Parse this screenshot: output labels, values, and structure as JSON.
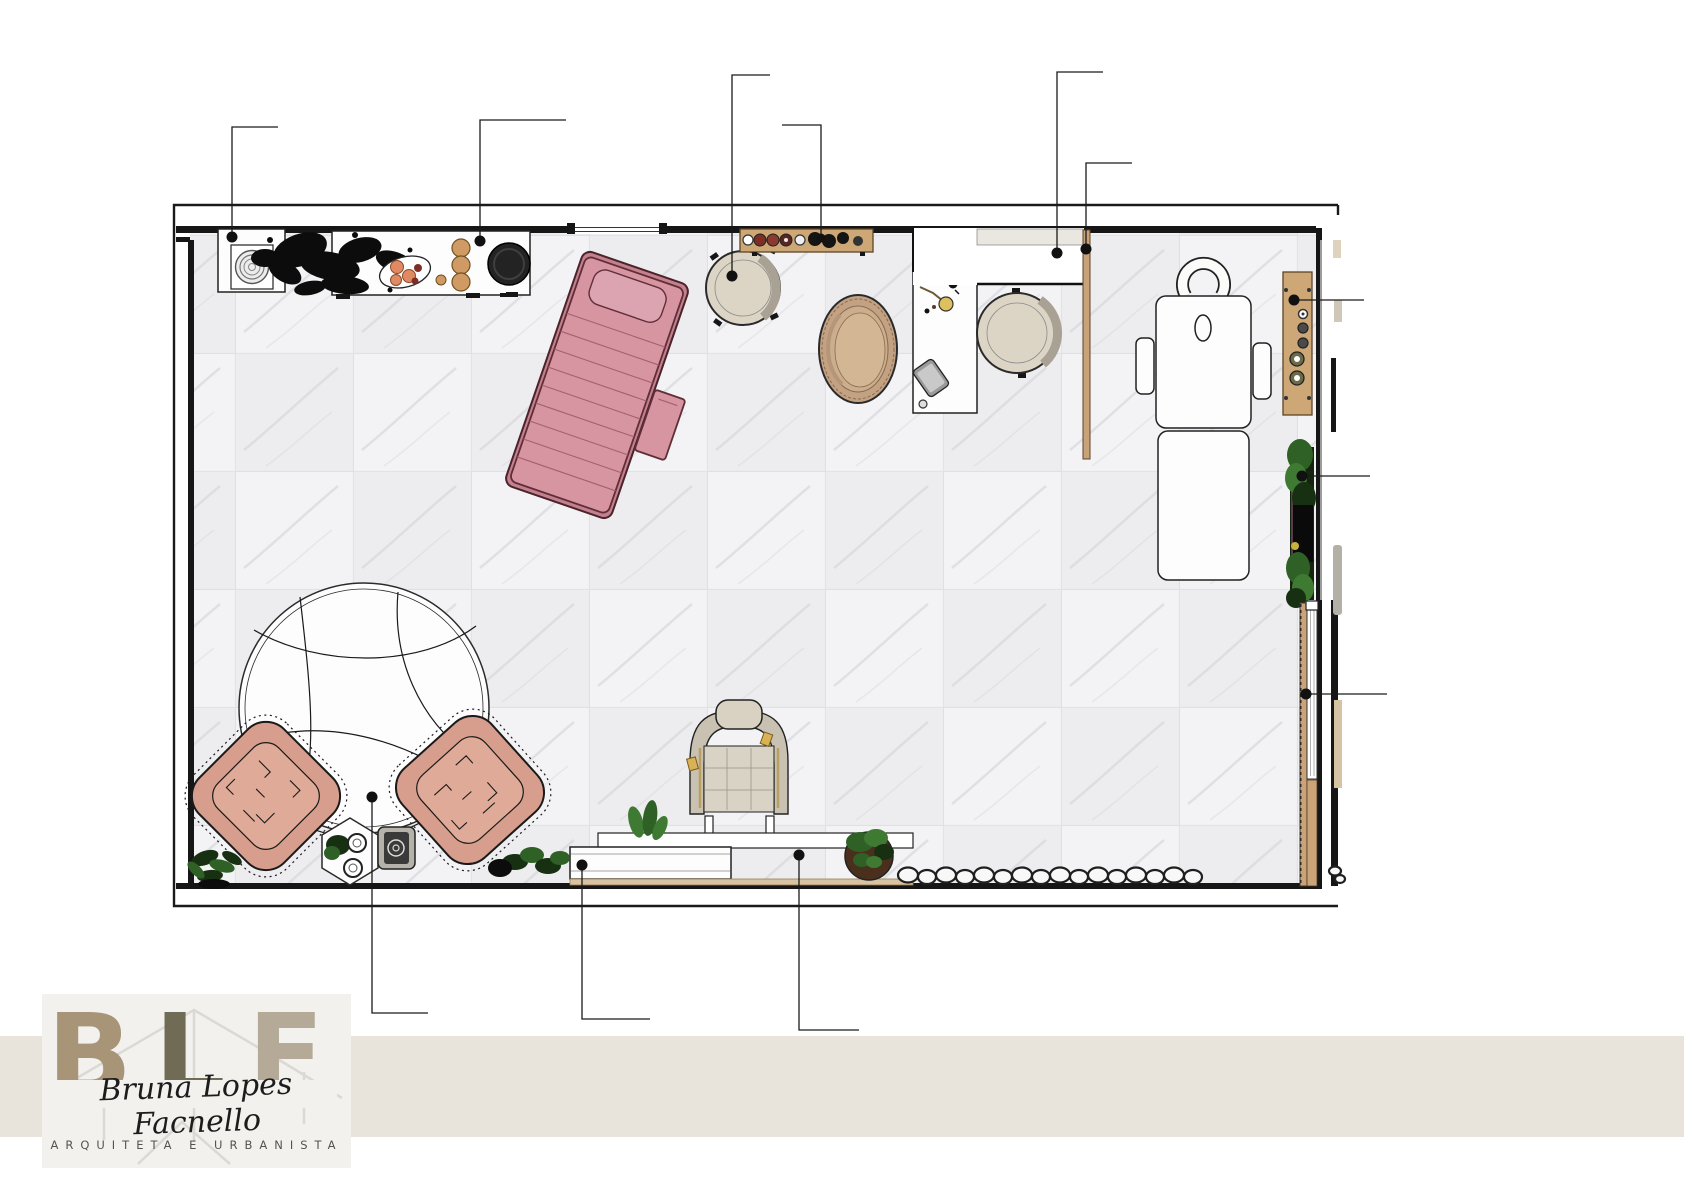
{
  "logo": {
    "letter_b": "B",
    "letter_l": "L",
    "letter_f": "F",
    "name": "Bruna Lopes Facnello",
    "subtitle": "ARQUITETA E URBANISTA"
  },
  "colors": {
    "band": "#e8e4dc",
    "logo_bg": "#f2f1ee",
    "wall": "#161616",
    "pink_bed": "#d795a1",
    "pink_bed_line": "#5f2e38",
    "pink_quilt": "#a4606e",
    "salmon_chair": "#d89e8d",
    "salmon_chair_light": "#dfaa97",
    "wood": "#cda876",
    "wood_dark": "#5d4527",
    "wood_strip": "#d8c3a3",
    "cream_seat": "#dcd5c5",
    "cream_band": "#a9a294",
    "egg_tan": "#c2a283",
    "gold": "#d8b254",
    "green_dark": "#173012",
    "green_mid": "#2f6127",
    "green_light": "#3f7a33",
    "letter_b": "#a89577",
    "letter_l": "#6f6b54",
    "letter_f": "#b4aa97",
    "signature_ink": "#1c1c1c",
    "subtitle_ink": "#55534e"
  },
  "furniture": [
    "washing machine cabinet",
    "decor counter with dried arrangements",
    "pink massage bed",
    "bed side tray",
    "round vanity stool",
    "wall cosmetics shelf",
    "egg lounge chair",
    "work desk with lamp and tablet",
    "round desk chair",
    "reception counter",
    "wood divider panel",
    "aesthetic treatment bed",
    "wall organizer shelf",
    "vertical garden",
    "wood slatted panel",
    "round rug",
    "lounge armchair left",
    "lounge armchair right",
    "hexagonal side table",
    "portable speaker",
    "styling chair",
    "low console",
    "planter ledge",
    "potted plant",
    "pebble border",
    "corner plant",
    "floor tiles",
    "room walls"
  ],
  "callouts": [
    "washing machine cabinet",
    "decor counter",
    "round stool",
    "cosmetics shelf",
    "reception counter",
    "divider panel",
    "organizer shelf",
    "vertical garden",
    "slatted panel",
    "round rug",
    "console left module",
    "console platform"
  ]
}
